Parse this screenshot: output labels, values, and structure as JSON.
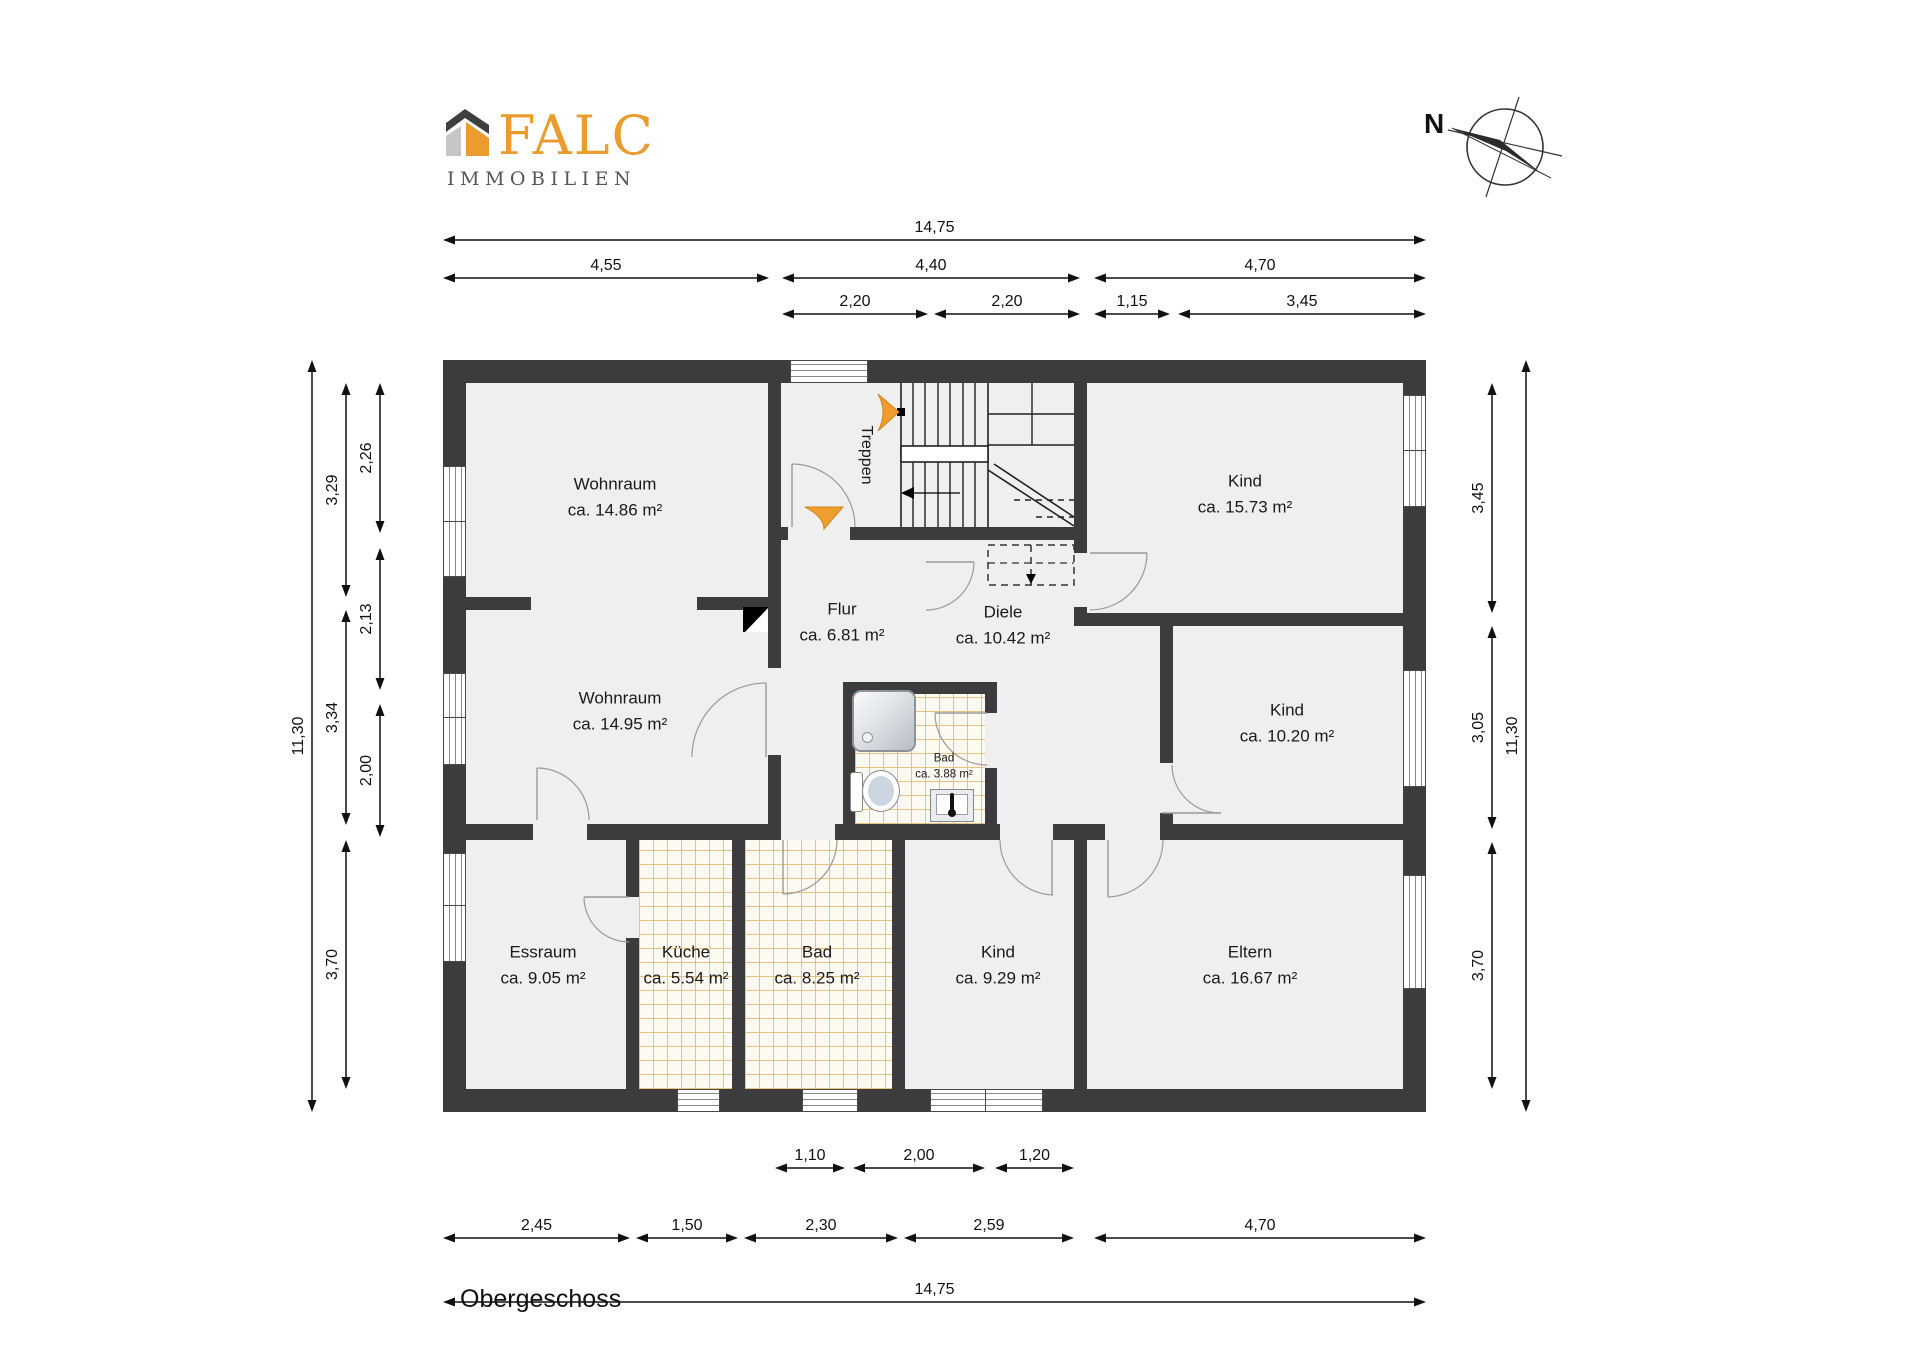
{
  "title": "Obergeschoss",
  "logo": {
    "name": "FALC",
    "subtitle": "IMMOBILIEN",
    "orange": "#EA9C2E",
    "dark_gray": "#3E3E40",
    "light_gray": "#C6C6C8",
    "subtitle_gray": "#55565A"
  },
  "compass": {
    "label": "N"
  },
  "stairs_label": "Treppen",
  "rooms": [
    {
      "name": "Wohnraum",
      "area": "ca. 14.86 m²"
    },
    {
      "name": "Wohnraum",
      "area": "ca. 14.95 m²"
    },
    {
      "name": "Kind",
      "area": "ca. 15.73 m²"
    },
    {
      "name": "Kind",
      "area": "ca. 10.20 m²"
    },
    {
      "name": "Flur",
      "area": "ca. 6.81 m²"
    },
    {
      "name": "Diele",
      "area": "ca. 10.42 m²"
    },
    {
      "name": "Bad",
      "area": "ca. 3.88 m²"
    },
    {
      "name": "Essraum",
      "area": "ca. 9.05 m²"
    },
    {
      "name": "Küche",
      "area": "ca. 5.54 m²"
    },
    {
      "name": "Bad",
      "area": "ca. 8.25 m²"
    },
    {
      "name": "Kind",
      "area": "ca. 9.29 m²"
    },
    {
      "name": "Eltern",
      "area": "ca. 16.67 m²"
    }
  ],
  "dimensions": {
    "top": [
      "14,75",
      "4,55",
      "4,40",
      "4,70",
      "2,20",
      "2,20",
      "1,15",
      "3,45"
    ],
    "bottom": [
      "1,10",
      "2,00",
      "1,20",
      "2,45",
      "1,50",
      "2,30",
      "2,59",
      "4,70",
      "14,75"
    ],
    "left": [
      "11,30",
      "3,29",
      "3,34",
      "3,70",
      "2,26",
      "2,13",
      "2,00"
    ],
    "right": [
      "3,45",
      "3,05",
      "3,70",
      "11,30"
    ]
  },
  "colors": {
    "wall": "#3c3c3e",
    "floor": "#efefef",
    "tile_line": "#eac27f",
    "tile_bg": "#fdfaf1",
    "accent_orange": "#EF9E2D",
    "dimension_ink": "#111111"
  }
}
